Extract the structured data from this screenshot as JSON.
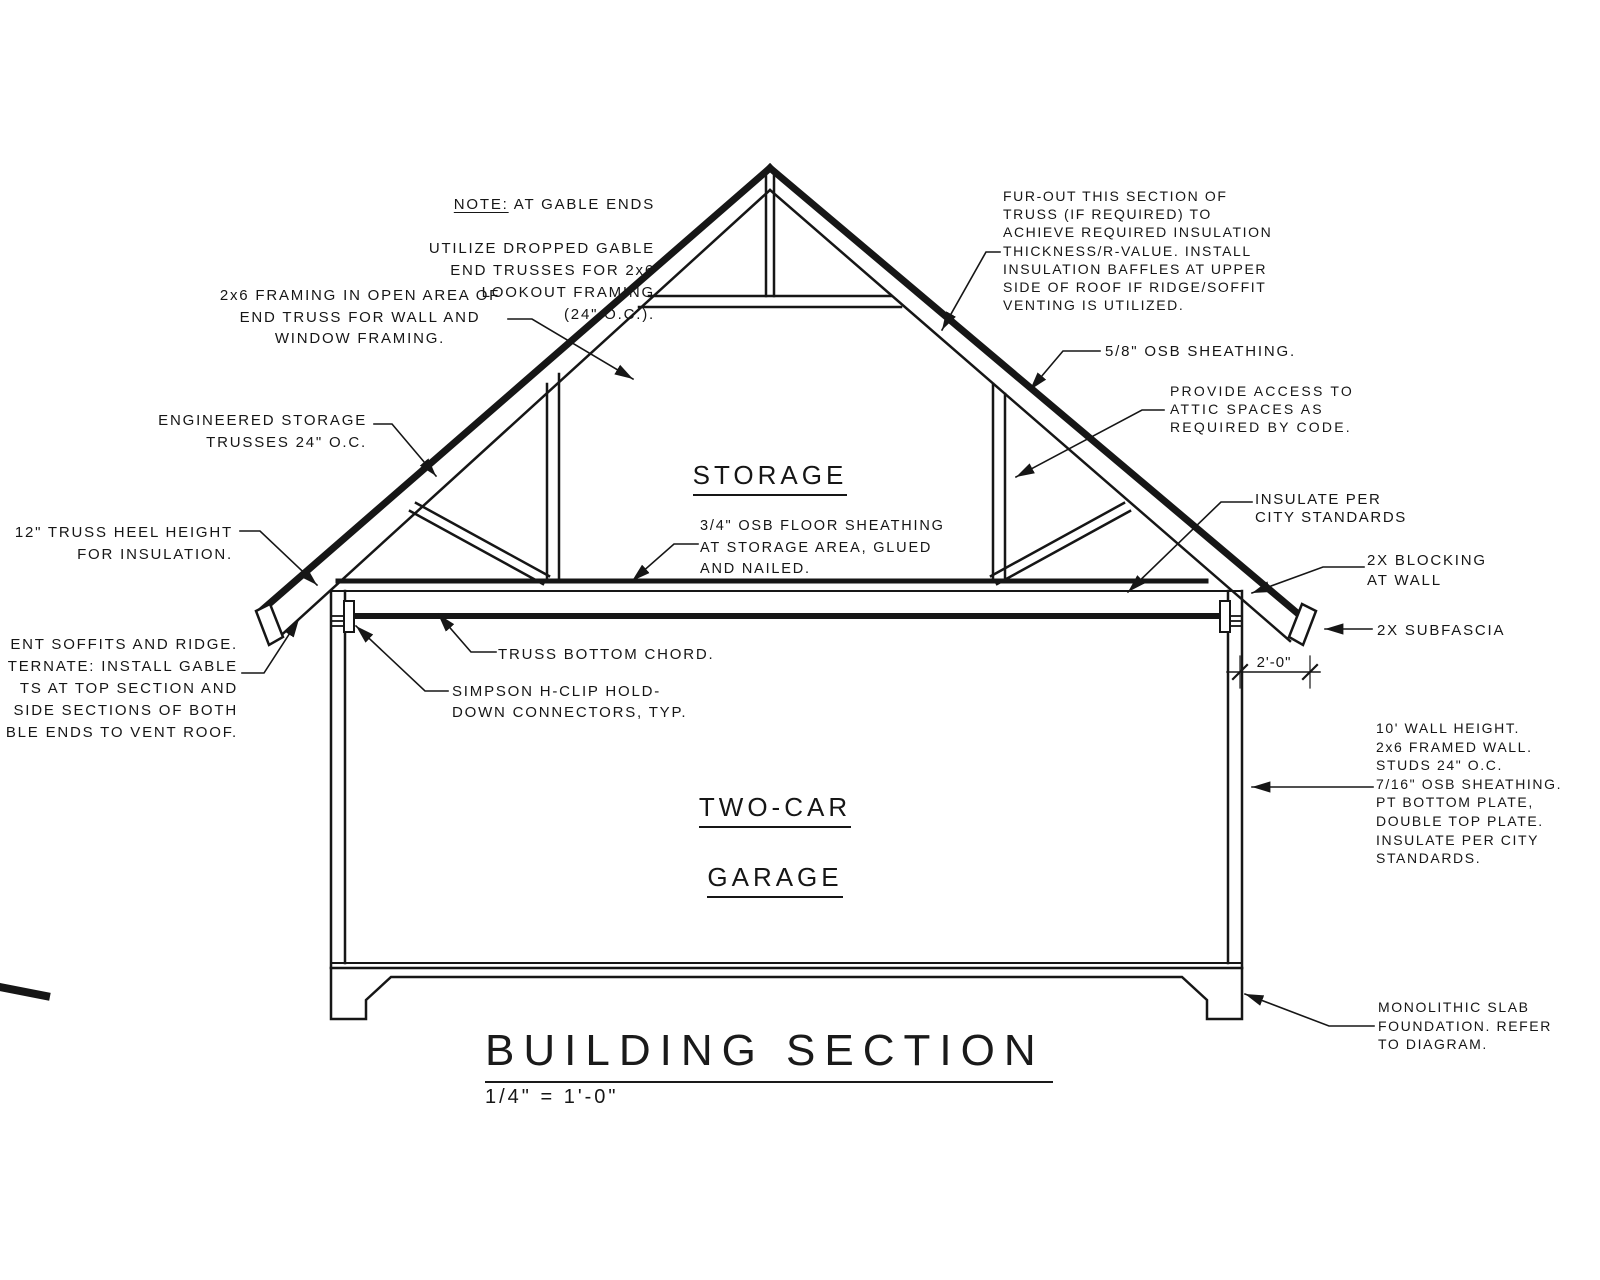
{
  "drawing": {
    "title": "BUILDING SECTION",
    "scale": "1/4\" = 1'-0\"",
    "rooms": {
      "storage": "STORAGE",
      "garage_line1": "TWO-CAR",
      "garage_line2": "GARAGE"
    },
    "dimension_heel": "2'-0\"",
    "notes": {
      "gable_note_label": "NOTE:",
      "gable_note_line1": " AT GABLE ENDS",
      "gable_note_rest": "UTILIZE DROPPED GABLE\nEND TRUSSES FOR 2x6\nLOOKOUT FRAMING\n(24\" O.C.).",
      "framing_2x6": "2x6 FRAMING IN OPEN AREA OF\nEND TRUSS FOR WALL AND\nWINDOW FRAMING.",
      "engineered_trusses": "ENGINEERED STORAGE\nTRUSSES 24\" O.C.",
      "truss_heel": "12\" TRUSS HEEL HEIGHT\nFOR INSULATION.",
      "vent_soffits_clipped": "ENT SOFFITS AND RIDGE.\nTERNATE: INSTALL GABLE\nTS AT TOP SECTION AND\nSIDE SECTIONS OF BOTH\nBLE ENDS TO VENT ROOF.",
      "fur_out": "FUR-OUT THIS SECTION OF\nTRUSS (IF REQUIRED) TO\nACHIEVE REQUIRED INSULATION\nTHICKNESS/R-VALUE. INSTALL\nINSULATION BAFFLES AT UPPER\nSIDE OF ROOF IF RIDGE/SOFFIT\nVENTING IS UTILIZED.",
      "osb_sheathing_58": "5/8\" OSB SHEATHING.",
      "attic_access": "PROVIDE ACCESS TO\nATTIC SPACES AS\nREQUIRED BY CODE.",
      "insulate_city": "INSULATE PER\nCITY STANDARDS",
      "blocking": "2X BLOCKING\nAT WALL",
      "subfascia": "2X SUBFASCIA",
      "osb_floor": "3/4\" OSB FLOOR SHEATHING\nAT STORAGE AREA, GLUED\nAND NAILED.",
      "truss_bottom_chord": "TRUSS BOTTOM CHORD.",
      "h_clip": "SIMPSON H-CLIP HOLD-\nDOWN CONNECTORS, TYP.",
      "wall_spec": "10' WALL HEIGHT.\n2x6 FRAMED WALL.\nSTUDS 24\" O.C.\n7/16\" OSB SHEATHING.\nPT BOTTOM PLATE,\nDOUBLE TOP PLATE.\nINSULATE PER CITY\nSTANDARDS.",
      "foundation": "MONOLITHIC SLAB\nFOUNDATION. REFER\nTO DIAGRAM."
    },
    "colors": {
      "ink": "#161616",
      "background": "#ffffff"
    }
  }
}
